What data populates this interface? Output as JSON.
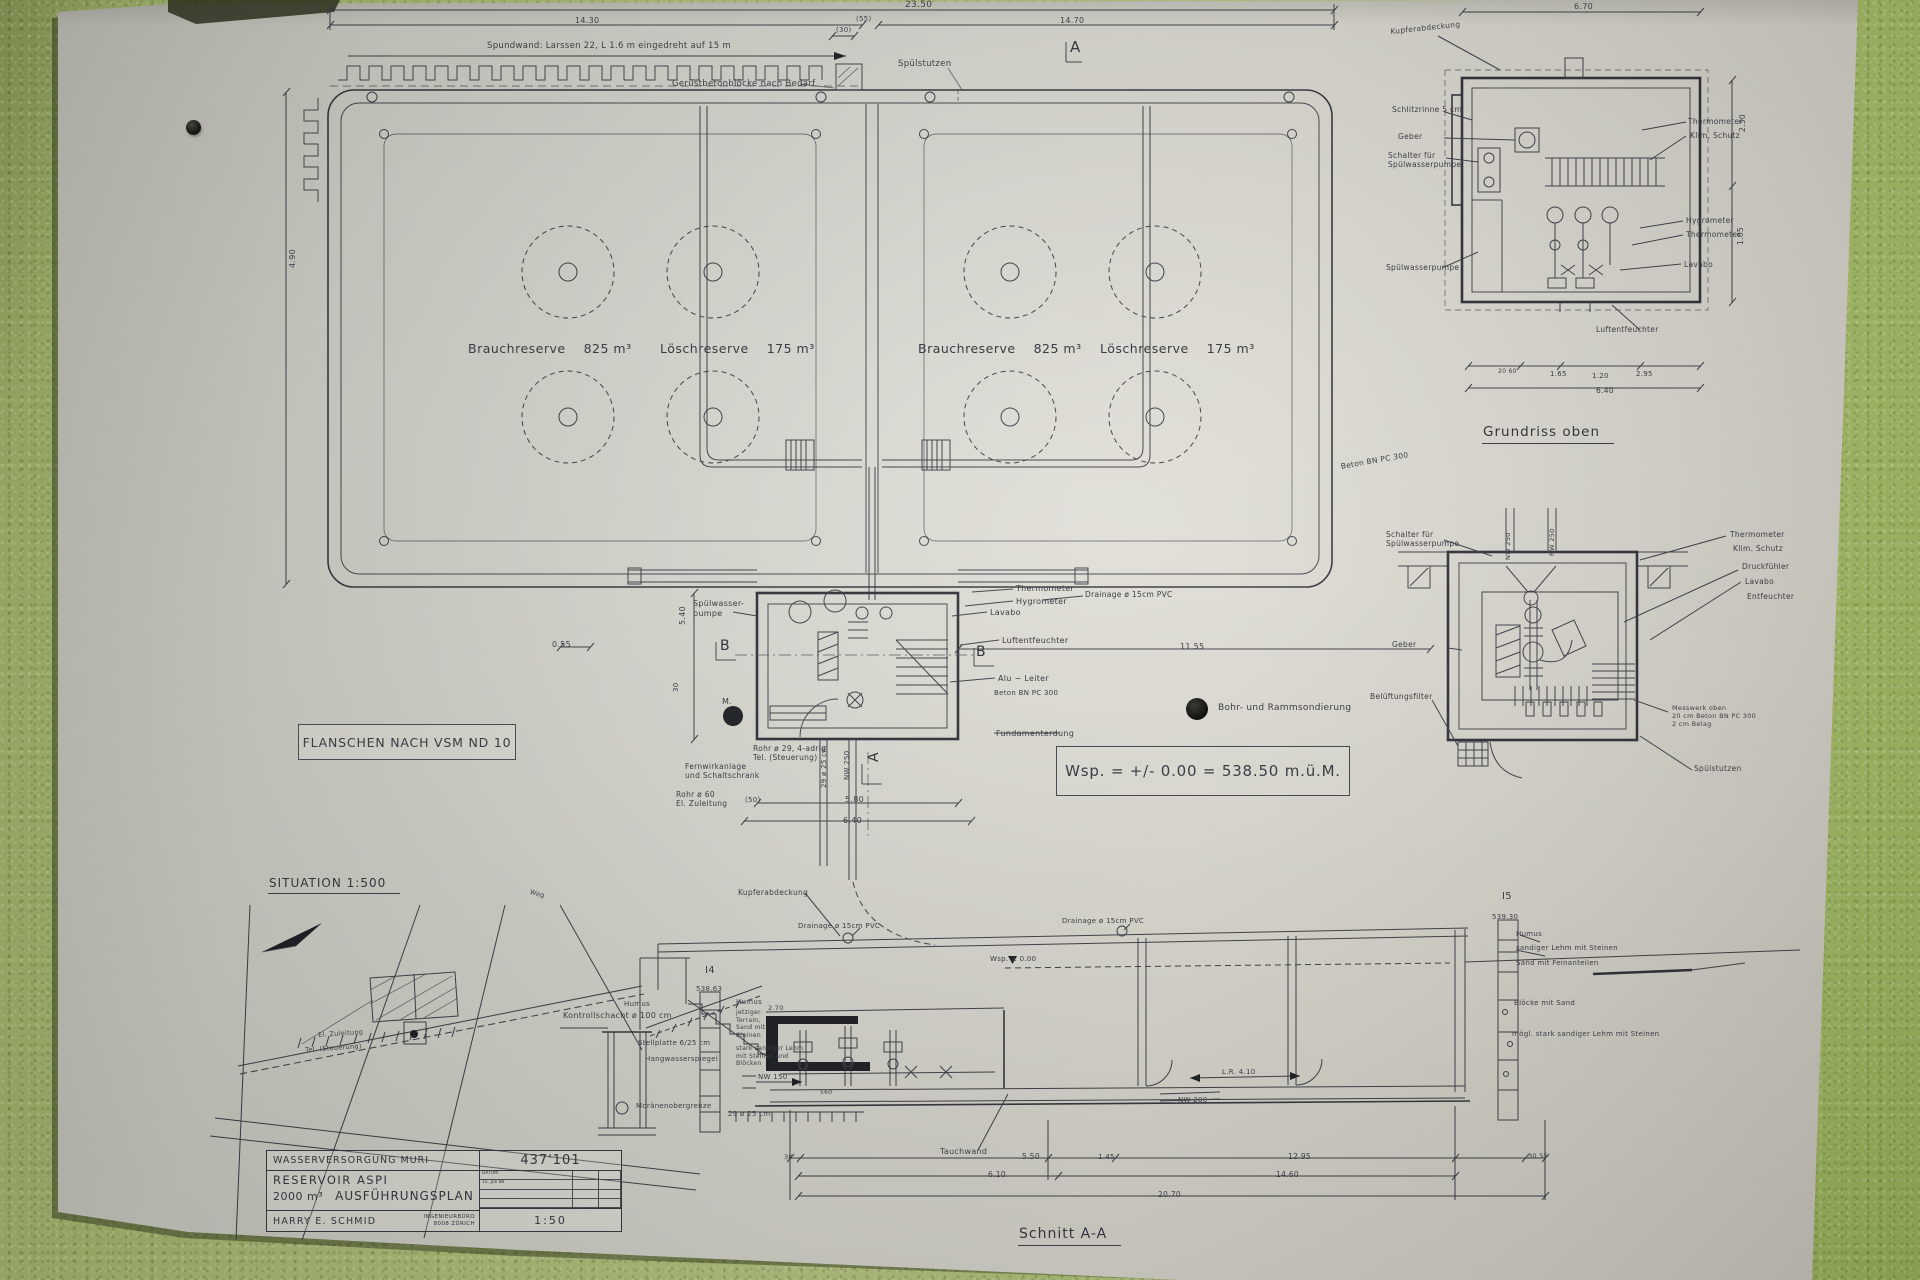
{
  "photo": {
    "wall_color": "#b4c57c",
    "paper_color": "#d9d8d0",
    "ink_color": "#3d3e47"
  },
  "titles": {
    "grundriss_oben": "Grundriss  oben",
    "situation": "SITUATION   1:500",
    "schnitt": "Schnitt  A-A"
  },
  "notes": {
    "flanschen": "FLANSCHEN  NACH  VSM  ND 10",
    "wsp": "Wsp. = +/- 0.00 = 538.50  m.ü.M."
  },
  "legend": {
    "bohr": "Bohr- und Rammsondierung"
  },
  "tanks": {
    "brauch_label": "Brauchreserve",
    "brauch_value": "825 m³",
    "loesch_label": "Löschreserve",
    "loesch_value": "175  m³"
  },
  "title_block": {
    "owner": "WASSERVERSORGUNG  MURI",
    "plan_no": "437'101",
    "project": "RESERVOIR   ASPI",
    "volume": "2000 m³",
    "plan_type": "AUSFÜHRUNGSPLAN",
    "engineer": "HARRY   E.   SCHMID",
    "office_line1": "INGENIEURBÜRO",
    "office_line2": "8008  ZÜRICH",
    "scale": "1:50",
    "date_label": "DATUM",
    "date_value": "15. Juli 86"
  },
  "annotations": [
    {
      "id": "dim-2350",
      "text": "23.50",
      "x": 905,
      "y": 0,
      "size": 9
    },
    {
      "id": "dim-1430",
      "text": "14.30",
      "x": 575,
      "y": 16,
      "size": 8
    },
    {
      "id": "dim-55",
      "text": "(55)",
      "x": 856,
      "y": 15,
      "size": 7
    },
    {
      "id": "dim-1470",
      "text": "14.70",
      "x": 1060,
      "y": 16,
      "size": 8
    },
    {
      "id": "spundwand-note",
      "text": "Spundwand:  Larssen 22,   L 1.6 m   eingedreht   auf  15 m",
      "x": 487,
      "y": 41,
      "size": 8.5
    },
    {
      "id": "geruestbeton-note",
      "text": "Gerüstbetonblöcke   nach  Bedarf",
      "x": 672,
      "y": 79,
      "size": 8.5
    },
    {
      "id": "spuelstutzen-top",
      "text": "Spülstutzen",
      "x": 898,
      "y": 59,
      "size": 8.5
    },
    {
      "id": "marker-a-top",
      "text": "A",
      "x": 1070,
      "y": 38,
      "size": 15,
      "cls": "marker"
    },
    {
      "id": "dim-30-top",
      "text": "(30)",
      "x": 836,
      "y": 26,
      "size": 7
    },
    {
      "id": "dim-490-left",
      "text": "4.90",
      "x": 288,
      "y": 268,
      "size": 8,
      "rot": -90
    },
    {
      "id": "spuelwasserpumpe-main",
      "text": "Spülwasser-\npumpe",
      "x": 693,
      "y": 599,
      "size": 8
    },
    {
      "id": "marker-b-left",
      "text": "B",
      "x": 720,
      "y": 638,
      "size": 14,
      "cls": "marker"
    },
    {
      "id": "marker-b-right",
      "text": "B",
      "x": 976,
      "y": 644,
      "size": 14,
      "cls": "marker"
    },
    {
      "id": "dim-540",
      "text": "5.40",
      "x": 678,
      "y": 625,
      "size": 8,
      "rot": -90
    },
    {
      "id": "dim-30-left",
      "text": "30",
      "x": 672,
      "y": 692,
      "size": 7,
      "rot": -90
    },
    {
      "id": "m-label",
      "text": "M.",
      "x": 722,
      "y": 697,
      "size": 8
    },
    {
      "id": "rohr29-note",
      "text": "Rohr ø 29,  4-adrig\nTel. (Steuerung)",
      "x": 753,
      "y": 744,
      "size": 7.5
    },
    {
      "id": "fernwirk-note",
      "text": "Fernwirkanlage\nund Schaltschrank",
      "x": 685,
      "y": 762,
      "size": 7.5
    },
    {
      "id": "rohr60-note",
      "text": "Rohr ø 60\nEl.  Zuleitung",
      "x": 676,
      "y": 790,
      "size": 7.5
    },
    {
      "id": "marker-a-bottom",
      "text": "A",
      "x": 866,
      "y": 762,
      "size": 14,
      "cls": "marker",
      "rot": -90
    },
    {
      "id": "dim-580",
      "text": "5.80",
      "x": 845,
      "y": 795,
      "size": 8
    },
    {
      "id": "dim-640",
      "text": "6.40",
      "x": 843,
      "y": 816,
      "size": 8
    },
    {
      "id": "dim-50",
      "text": "(50)",
      "x": 745,
      "y": 796,
      "size": 7
    },
    {
      "id": "nw250-pipe",
      "text": "NW 250",
      "x": 843,
      "y": 780,
      "size": 7,
      "rot": -90
    },
    {
      "id": "pipe29-v",
      "text": "29 ø 25 cm",
      "x": 820,
      "y": 788,
      "size": 7,
      "rot": -90
    },
    {
      "id": "thermometer-main",
      "text": "Thermometer",
      "x": 1016,
      "y": 584,
      "size": 8
    },
    {
      "id": "hygrometer-main",
      "text": "Hygrometer",
      "x": 1016,
      "y": 597,
      "size": 8
    },
    {
      "id": "drainage-main",
      "text": "Drainage   ø 15cm   PVC",
      "x": 1085,
      "y": 590,
      "size": 7.5
    },
    {
      "id": "lavabo-main",
      "text": "Lavabo",
      "x": 990,
      "y": 608,
      "size": 8
    },
    {
      "id": "luftentfeuchter-main",
      "text": "Luftentfeuchter",
      "x": 1002,
      "y": 636,
      "size": 8
    },
    {
      "id": "dim-1155",
      "text": "11.55",
      "x": 1180,
      "y": 642,
      "size": 8
    },
    {
      "id": "dim-055",
      "text": "0.55",
      "x": 552,
      "y": 640,
      "size": 8
    },
    {
      "id": "alu-leiter",
      "text": "Alu − Leiter",
      "x": 998,
      "y": 674,
      "size": 8
    },
    {
      "id": "beton-bn-main",
      "text": "Beton BN PC 300",
      "x": 994,
      "y": 689,
      "size": 7
    },
    {
      "id": "fundamenterdung",
      "text": "Fundamenterdung",
      "x": 996,
      "y": 729,
      "size": 8
    },
    {
      "id": "beton-diag",
      "text": "Beton  BN PC 300",
      "x": 1340,
      "y": 462,
      "size": 7.5,
      "rot": -10
    },
    {
      "id": "kupferabdeckung-tr",
      "text": "Kupferabdeckung",
      "x": 1390,
      "y": 27,
      "size": 7.5,
      "rot": -6
    },
    {
      "id": "schlitzrinne-tr",
      "text": "Schlitzrinne  5 cm",
      "x": 1392,
      "y": 105,
      "size": 7.5
    },
    {
      "id": "geber-tr",
      "text": "Geber",
      "x": 1398,
      "y": 132,
      "size": 7.5
    },
    {
      "id": "schalter-tr",
      "text": "Schalter  für\nSpülwasserpumpe",
      "x": 1388,
      "y": 151,
      "size": 7.5
    },
    {
      "id": "spuelwasserpumpe-tr",
      "text": "Spülwasserpumpe",
      "x": 1386,
      "y": 263,
      "size": 7.5
    },
    {
      "id": "thermometer-tr",
      "text": "Thermometer",
      "x": 1688,
      "y": 117,
      "size": 7.5
    },
    {
      "id": "klim-schutz-tr",
      "text": "Klim. Schutz",
      "x": 1690,
      "y": 131,
      "size": 7.5
    },
    {
      "id": "hygrometer-tr",
      "text": "Hygrometer",
      "x": 1686,
      "y": 216,
      "size": 7.5
    },
    {
      "id": "thermometer2-tr",
      "text": "Thermometer",
      "x": 1686,
      "y": 230,
      "size": 7.5
    },
    {
      "id": "lavabo-tr",
      "text": "Lavabo",
      "x": 1684,
      "y": 260,
      "size": 7.5
    },
    {
      "id": "luftentfeuchter-tr",
      "text": "Luftentfeuchter",
      "x": 1596,
      "y": 325,
      "size": 7.5
    },
    {
      "id": "dim-670-tr",
      "text": "6.70",
      "x": 1574,
      "y": 2,
      "size": 8
    },
    {
      "id": "dim-230-tr",
      "text": "2.30",
      "x": 1738,
      "y": 132,
      "size": 7.5,
      "rot": -90
    },
    {
      "id": "dim-165v-tr",
      "text": "1.65",
      "x": 1736,
      "y": 245,
      "size": 7.5,
      "rot": -90
    },
    {
      "id": "dim-2060-tr",
      "text": "20  60",
      "x": 1498,
      "y": 368,
      "size": 6
    },
    {
      "id": "dim-165-tr",
      "text": "1.65",
      "x": 1550,
      "y": 370,
      "size": 7
    },
    {
      "id": "dim-120-tr",
      "text": "1.20",
      "x": 1592,
      "y": 372,
      "size": 7
    },
    {
      "id": "dim-295-tr",
      "text": "2.95",
      "x": 1636,
      "y": 370,
      "size": 7
    },
    {
      "id": "dim-640-tr",
      "text": "6.40",
      "x": 1596,
      "y": 386,
      "size": 7.5
    },
    {
      "id": "schalter-mr",
      "text": "Schalter  für\nSpülwasserpumpe",
      "x": 1386,
      "y": 530,
      "size": 7.5
    },
    {
      "id": "nw250-mr1",
      "text": "NW 250",
      "x": 1504,
      "y": 560,
      "size": 6.5,
      "rot": -90
    },
    {
      "id": "nw250-mr2",
      "text": "NW 250",
      "x": 1548,
      "y": 556,
      "size": 6.5,
      "rot": -90
    },
    {
      "id": "thermometer-mr",
      "text": "Thermometer",
      "x": 1730,
      "y": 530,
      "size": 7.5
    },
    {
      "id": "klim-schutz-mr",
      "text": "Klim. Schutz",
      "x": 1733,
      "y": 544,
      "size": 7.5
    },
    {
      "id": "druckfuehler-mr",
      "text": "Druckfühler",
      "x": 1742,
      "y": 562,
      "size": 7.5
    },
    {
      "id": "lavabo-mr",
      "text": "Lavabo",
      "x": 1745,
      "y": 577,
      "size": 7.5
    },
    {
      "id": "entfeuchter-mr",
      "text": "Entfeuchter",
      "x": 1747,
      "y": 592,
      "size": 7.5
    },
    {
      "id": "geber-mr",
      "text": "Geber",
      "x": 1392,
      "y": 640,
      "size": 7.5
    },
    {
      "id": "belueftungsfilter-mr",
      "text": "Belüftungsfilter",
      "x": 1370,
      "y": 692,
      "size": 7.5
    },
    {
      "id": "messwerk-note",
      "text": "Messwerk oben\n20 cm Beton BN PC 300\n2 cm Belag",
      "x": 1672,
      "y": 704,
      "size": 6.5
    },
    {
      "id": "spuelstutzen-mr",
      "text": "Spülstutzen",
      "x": 1694,
      "y": 764,
      "size": 7.5
    },
    {
      "id": "weg-label",
      "text": "Weg",
      "x": 531,
      "y": 888,
      "size": 6.5,
      "rot": 15
    },
    {
      "id": "zuleitung-label",
      "text": "El. Zuleitung",
      "x": 318,
      "y": 1031,
      "size": 6.5,
      "rot": -4
    },
    {
      "id": "tel-label",
      "text": "Tel. (Steuerung)",
      "x": 305,
      "y": 1046,
      "size": 6.5,
      "rot": -4
    },
    {
      "id": "kupferabdeckung-b",
      "text": "Kupferabdeckung",
      "x": 738,
      "y": 888,
      "size": 7.5
    },
    {
      "id": "drainage-b1",
      "text": "Drainage  ø 15cm  PVC",
      "x": 798,
      "y": 922,
      "size": 7
    },
    {
      "id": "drainage-b2",
      "text": "Drainage  ø 15cm  PVC",
      "x": 1062,
      "y": 917,
      "size": 7
    },
    {
      "id": "i4-label",
      "text": "I4",
      "x": 705,
      "y": 965,
      "size": 10
    },
    {
      "id": "i4-elev",
      "text": "538.63",
      "x": 696,
      "y": 985,
      "size": 7
    },
    {
      "id": "i5-label",
      "text": "I5",
      "x": 1502,
      "y": 891,
      "size": 10
    },
    {
      "id": "i5-elev",
      "text": "539.30",
      "x": 1492,
      "y": 913,
      "size": 7
    },
    {
      "id": "kontrollschacht-b",
      "text": "Kontrollschacht ø 100 cm",
      "x": 563,
      "y": 1011,
      "size": 8
    },
    {
      "id": "humus-l",
      "text": "Humus",
      "x": 624,
      "y": 1000,
      "size": 7
    },
    {
      "id": "stellplatte-b",
      "text": "Stellplatte   6/25 cm",
      "x": 638,
      "y": 1039,
      "size": 7
    },
    {
      "id": "hangwasserspiegel-b",
      "text": "Hangwasserspiegel",
      "x": 645,
      "y": 1055,
      "size": 7
    },
    {
      "id": "moraene-l",
      "text": "Moränenobergrenze",
      "x": 636,
      "y": 1102,
      "size": 7
    },
    {
      "id": "humus-m",
      "text": "Humus",
      "x": 736,
      "y": 998,
      "size": 7
    },
    {
      "id": "jetziger-note",
      "text": "jetziger\nTerrain,\nSand mit\nSteinen",
      "x": 736,
      "y": 1009,
      "size": 6
    },
    {
      "id": "stark-sandiger-note",
      "text": "stark sandiger Lehm\nmit Steinen und\nBlöcken",
      "x": 736,
      "y": 1045,
      "size": 6
    },
    {
      "id": "dim-270-b",
      "text": "2.70",
      "x": 768,
      "y": 1004,
      "size": 6.5
    },
    {
      "id": "nw150-b",
      "text": "NW 150",
      "x": 758,
      "y": 1073,
      "size": 7
    },
    {
      "id": "pile29-b",
      "text": "29 ø 25 cm",
      "x": 728,
      "y": 1110,
      "size": 7
    },
    {
      "id": "dim-560-b",
      "text": "560",
      "x": 820,
      "y": 1089,
      "size": 6
    },
    {
      "id": "wsp-b",
      "text": "Wsp. ± 0.00",
      "x": 990,
      "y": 955,
      "size": 7
    },
    {
      "id": "lr410-b",
      "text": "L.R. 4.10",
      "x": 1222,
      "y": 1068,
      "size": 7
    },
    {
      "id": "nw200-b",
      "text": "NW 200",
      "x": 1178,
      "y": 1096,
      "size": 7
    },
    {
      "id": "tauchwand-b",
      "text": "Tauchwand",
      "x": 940,
      "y": 1147,
      "size": 8
    },
    {
      "id": "humus-r",
      "text": "Humus",
      "x": 1516,
      "y": 930,
      "size": 7
    },
    {
      "id": "sandiger-r",
      "text": "sandiger Lehm mit Steinen",
      "x": 1516,
      "y": 944,
      "size": 7
    },
    {
      "id": "sand-fein-r",
      "text": "Sand mit Feinanteilen",
      "x": 1516,
      "y": 959,
      "size": 7
    },
    {
      "id": "bloecke-r",
      "text": "Blöcke  mit  Sand",
      "x": 1514,
      "y": 999,
      "size": 7
    },
    {
      "id": "moegl-r",
      "text": "mögl. stark sandiger Lehm mit Steinen",
      "x": 1512,
      "y": 1030,
      "size": 7
    },
    {
      "id": "dim-30-b1",
      "text": "30",
      "x": 784,
      "y": 1153,
      "size": 6.5
    },
    {
      "id": "dim-550-b",
      "text": "5.50",
      "x": 1022,
      "y": 1152,
      "size": 7.5
    },
    {
      "id": "dim-145-b",
      "text": "1.45",
      "x": 1098,
      "y": 1153,
      "size": 7
    },
    {
      "id": "dim-1295-b",
      "text": "12.95",
      "x": 1288,
      "y": 1152,
      "size": 7.5
    },
    {
      "id": "dim-3055-b",
      "text": "30  55",
      "x": 1528,
      "y": 1152,
      "size": 6.5
    },
    {
      "id": "dim-610-b",
      "text": "6.10",
      "x": 988,
      "y": 1170,
      "size": 7.5
    },
    {
      "id": "dim-1460-b",
      "text": "14.60",
      "x": 1276,
      "y": 1170,
      "size": 7.5
    },
    {
      "id": "dim-2070-b",
      "text": "20.70",
      "x": 1158,
      "y": 1190,
      "size": 7.5
    }
  ]
}
